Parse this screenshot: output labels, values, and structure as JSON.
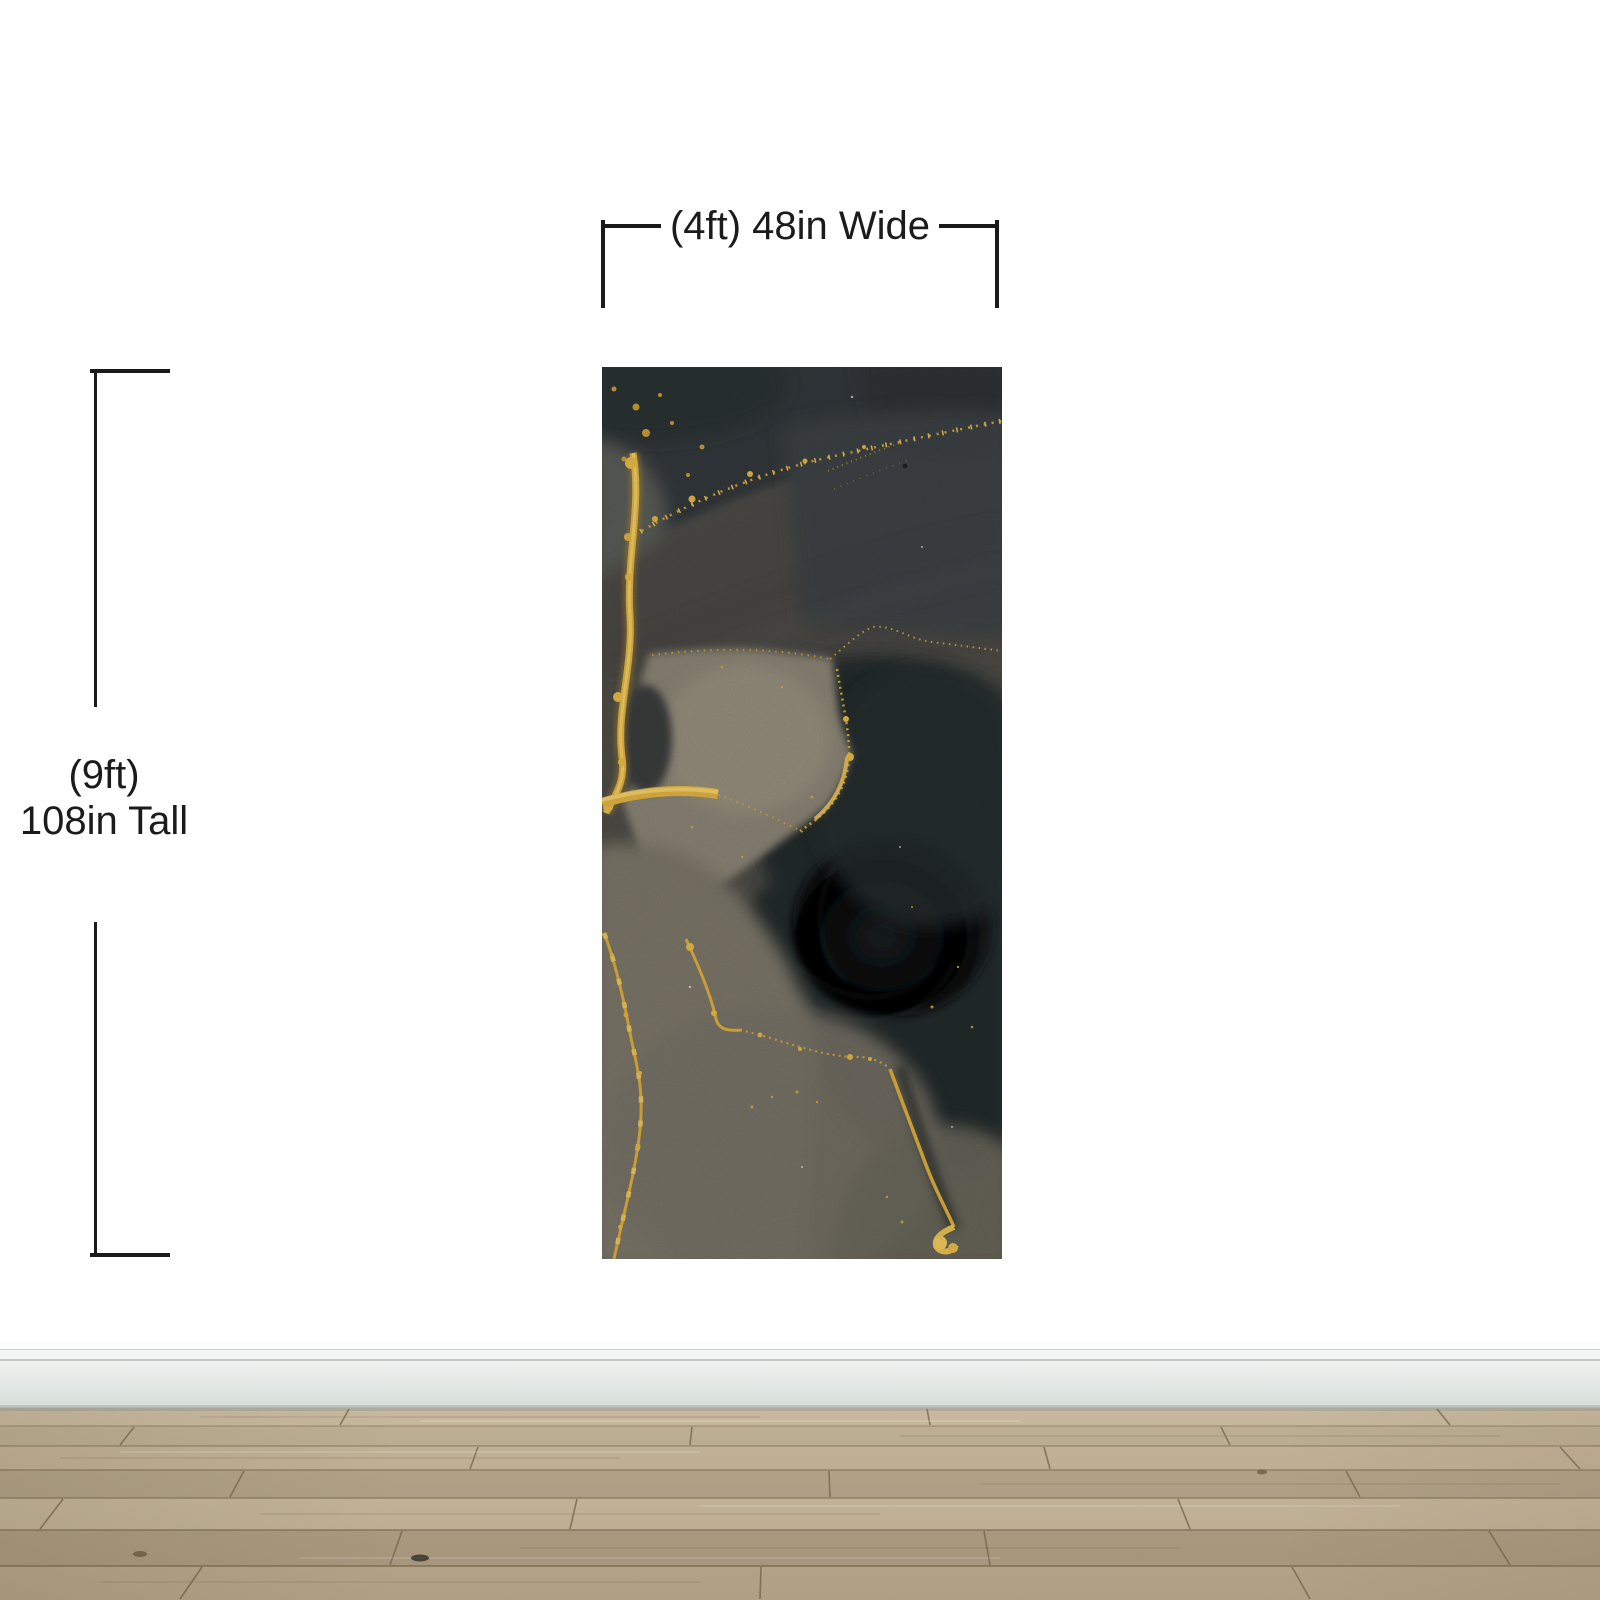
{
  "scene": {
    "type": "wall-mural-size-mockup"
  },
  "labels": {
    "width": "(4ft) 48in Wide",
    "height_ft": "(9ft)",
    "height_in": "108in Tall"
  },
  "palette": {
    "wall": "#ffffff",
    "dimension_line": "#1a1a1a",
    "label_text": "#1b1b1b",
    "mural_black": "#22272a",
    "mural_smoke": "#4b4a44",
    "mural_taupe": "#8d8576",
    "mural_gold": "#e2b443",
    "baseboard": "#e6ebe8",
    "floor_wood_light": "#c6b79c",
    "floor_wood_dark": "#b0a185",
    "floor_seam": "#7d6e53"
  }
}
